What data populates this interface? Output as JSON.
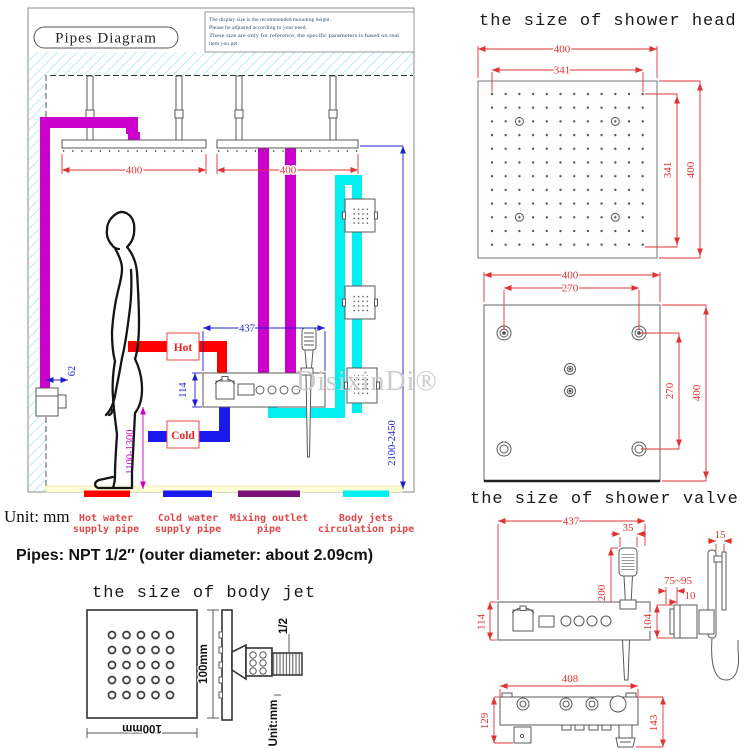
{
  "watermark": "DisixinDi®",
  "main_diagram": {
    "title": "Pipes Diagram",
    "note": {
      "line1": "The display size is the recommended mounting height.",
      "line2": "Please be adjusted according to your need.",
      "line3": "These size are only for reference, the specific parameters is based on real",
      "line4": "item you get."
    },
    "labels": {
      "hot": "Hot",
      "cold": "Cold"
    },
    "dims": {
      "left_head_width": "400",
      "right_head_width": "400",
      "valve_width": "437",
      "valve_height": "114",
      "body_spray_offset": "62",
      "valve_height_from_floor": "1100-1300",
      "head_height_from_floor": "2100-2450"
    }
  },
  "legend": {
    "unit": "Unit: mm",
    "items": [
      {
        "line1": "Hot water",
        "line2": "supply pipe",
        "color": "#ff0000"
      },
      {
        "line1": "Cold water",
        "line2": "supply pipe",
        "color": "#1a1aee"
      },
      {
        "line1": "Mixing outlet",
        "line2": "pipe",
        "color": "#7b0f7b"
      },
      {
        "line1": "Body jets",
        "line2": "circulation pipe",
        "color": "#00efef"
      }
    ]
  },
  "pipes_spec": "Pipes: NPT 1/2″ (outer diameter: about 2.09cm)",
  "shower_head": {
    "title": "the size of shower head",
    "front": {
      "outer_width": "400",
      "nozzle_width": "341",
      "nozzle_height": "341",
      "outer_height": "400"
    },
    "back": {
      "outer_width": "400",
      "hole_spacing_w": "270",
      "hole_spacing_h": "270",
      "outer_height": "400"
    }
  },
  "shower_valve": {
    "title": "the size of shower valve",
    "dims": {
      "panel_width": "437",
      "handshower_width": "35",
      "handshower_length": "200",
      "bracket_offset": "15",
      "wall_depth_range": "75~95",
      "plate_thickness": "10",
      "panel_height": "114",
      "side_height": "104",
      "base_width": "408",
      "base_height_left": "129",
      "base_height_right": "143"
    }
  },
  "body_jet": {
    "title": "the size of body jet",
    "height_label": "100mm",
    "width_label": "100mm",
    "thread_label": "1/2",
    "unit_label": "Unit:mm"
  }
}
